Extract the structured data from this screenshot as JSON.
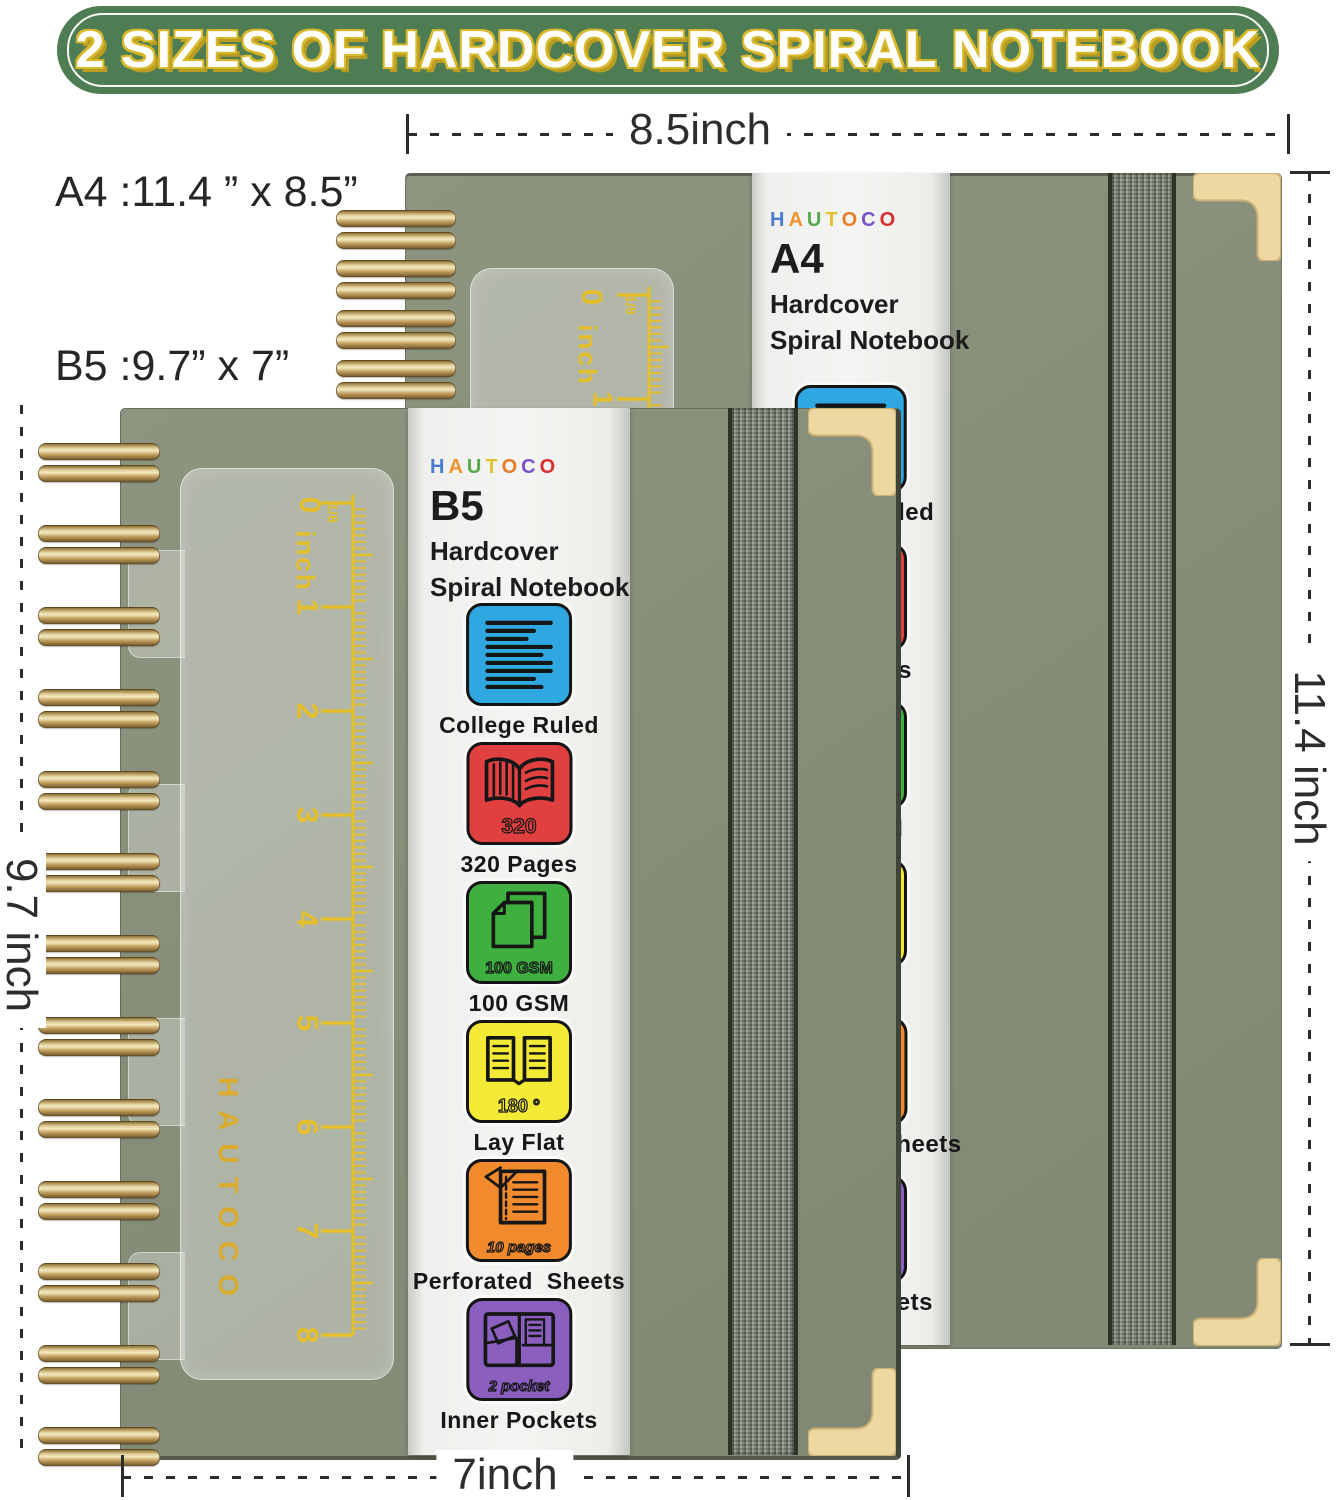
{
  "banner": {
    "title": "2 SIZES OF HARDCOVER SPIRAL NOTEBOOK"
  },
  "dimensions": {
    "a4_label": "A4 :11.4 ” x 8.5”",
    "b5_label": "B5 :9.7” x 7”",
    "top": "8.5inch",
    "right": "11.4 inch",
    "left": "9.7 inch",
    "bottom": "7inch"
  },
  "brand": {
    "name": "HAUTOCO",
    "letters": [
      {
        "char": "H",
        "color": "#4a7bd0"
      },
      {
        "char": "A",
        "color": "#f0922b"
      },
      {
        "char": "U",
        "color": "#57a84f"
      },
      {
        "char": "T",
        "color": "#e3c22f"
      },
      {
        "char": "O",
        "color": "#e87d28"
      },
      {
        "char": "C",
        "color": "#7c52c8"
      },
      {
        "char": "O",
        "color": "#d62f2f"
      }
    ]
  },
  "notebooks": {
    "a4": {
      "size": "A4",
      "line1": "Hardcover",
      "line2": "Spiral Notebook"
    },
    "b5": {
      "size": "B5",
      "line1": "Hardcover",
      "line2": "Spiral Notebook"
    }
  },
  "features": [
    {
      "id": "college-ruled",
      "label": "College Ruled",
      "color": "#2fa8e1",
      "badge": ""
    },
    {
      "id": "pages-320",
      "label": "320 Pages",
      "color": "#e04040",
      "badge": "320"
    },
    {
      "id": "gsm-100",
      "label": "100 GSM",
      "color": "#3faf3f",
      "badge": "100 GSM"
    },
    {
      "id": "lay-flat",
      "label": "Lay Flat",
      "color": "#f2ea35",
      "badge": "180 °"
    },
    {
      "id": "perforated",
      "label": "Perforated  Sheets",
      "color": "#f08a2d",
      "badge": "10 pages"
    },
    {
      "id": "inner-pockets",
      "label": "Inner Pockets",
      "color": "#8a5fc0",
      "badge": "2 pocket"
    }
  ],
  "ruler": {
    "zero": "0",
    "unit": "inch",
    "fraction": "1/8",
    "numbers": [
      "1",
      "2",
      "3",
      "4",
      "5",
      "6",
      "7",
      "8"
    ]
  },
  "cover_brand": "HAUTOCO",
  "colors": {
    "cover": "#868E7A",
    "banner_green": "#4E7C53",
    "banner_outline_yellow": "#D9B92C",
    "gold_wire": "#C9A86A",
    "gold_corner": "#EED8A2",
    "ruler_marks": "#E3BF2D",
    "cover_brand_gold": "#D9AB2E",
    "band_white": "#F4F5F2",
    "elastic": "#7E8676",
    "dimension_text": "#2D2D2D"
  }
}
